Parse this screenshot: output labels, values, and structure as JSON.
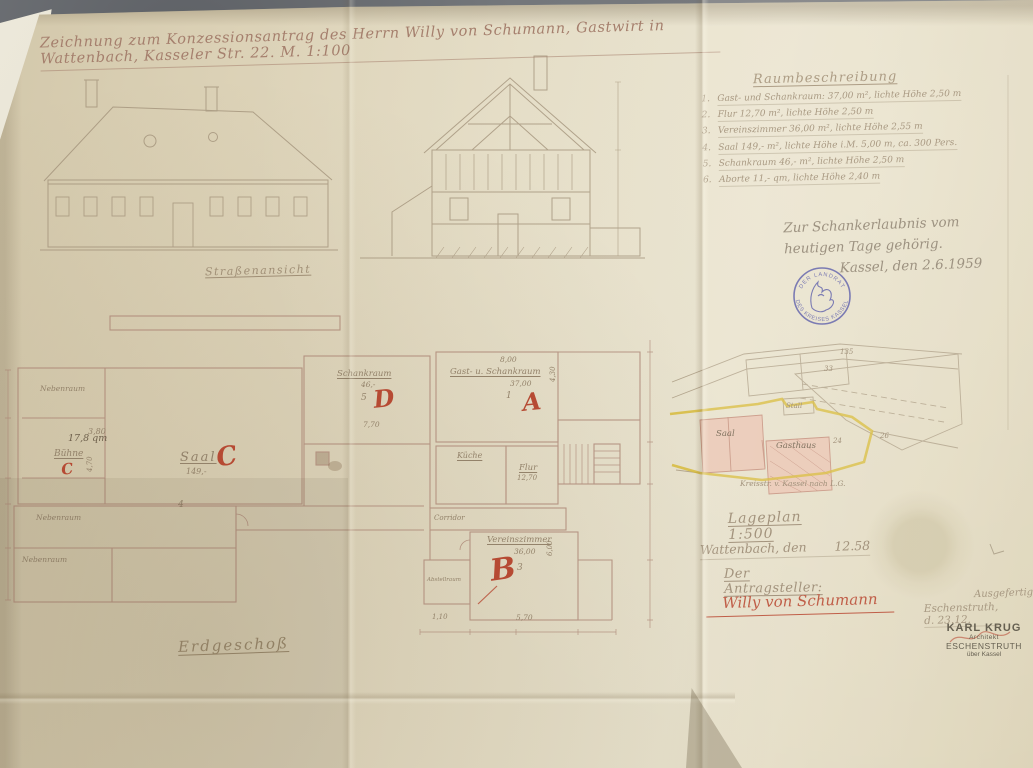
{
  "colors": {
    "paper": "#ded4ba",
    "background": "#74777b",
    "pencil": "#9b8a72",
    "red_ink": "#b64a33",
    "blue_stamp": "#4649a2",
    "yellow_boundary": "#d6b832",
    "pink_building": "#eac3b2"
  },
  "title": {
    "text": "Zeichnung zum Konzessionsantrag des Herrn Willy von Schumann, Gastwirt in Wattenbach, Kasseler Str. 22. M. 1:100"
  },
  "room_description": {
    "heading": "Raumbeschreibung",
    "items": [
      {
        "num": "1.",
        "text": "Gast- und Schankraum: 37,00 m², lichte Höhe 2,50 m"
      },
      {
        "num": "2.",
        "text": "Flur 12,70 m², lichte Höhe 2,50 m"
      },
      {
        "num": "3.",
        "text": "Vereinszimmer 36,00 m², lichte Höhe 2,55 m"
      },
      {
        "num": "4.",
        "text": "Saal 149,- m², lichte Höhe i.M. 5,00 m, ca. 300 Pers."
      },
      {
        "num": "5.",
        "text": "Schankraum 46,- m², lichte Höhe 2,50 m"
      },
      {
        "num": "6.",
        "text": "Aborte 11,- qm, lichte Höhe 2,40 m"
      }
    ]
  },
  "approval_note": {
    "line1": "Zur Schankerlaubnis vom",
    "line2": "heutigen Tage gehörig.",
    "line3": "Kassel, den 2.6.1959"
  },
  "official_stamp": {
    "top": "DER LANDRAT",
    "bottom": "DES KREISES KASSEL"
  },
  "elevation": {
    "caption": "Straßenansicht"
  },
  "floor_plan": {
    "caption": "Erdgeschoß",
    "labels": [
      {
        "text": "Nebenraum",
        "x": 40,
        "y": 384,
        "fs": 7.5
      },
      {
        "text": "3,80",
        "x": 88,
        "y": 427,
        "fs": 8
      },
      {
        "text": "17,8 qm",
        "x": 68,
        "y": 433,
        "fs": 9.5,
        "cls": "dark"
      },
      {
        "text": "Bühne",
        "x": 54,
        "y": 449,
        "fs": 9,
        "u": true
      },
      {
        "text": "C",
        "x": 60,
        "y": 461,
        "fs": 15,
        "cls": "red",
        "rot": -8
      },
      {
        "text": "4,70",
        "x": 86,
        "y": 472,
        "fs": 7,
        "rot": -90
      },
      {
        "text": "Saal",
        "x": 180,
        "y": 450,
        "fs": 13,
        "ls": 2,
        "u": true
      },
      {
        "text": "149,-",
        "x": 186,
        "y": 467,
        "fs": 8
      },
      {
        "text": "C",
        "x": 214,
        "y": 444,
        "fs": 26,
        "cls": "red",
        "rot": -10
      },
      {
        "text": "4",
        "x": 178,
        "y": 500,
        "fs": 9
      },
      {
        "text": "Nebenraum",
        "x": 36,
        "y": 513,
        "fs": 7.5
      },
      {
        "text": "Nebenraum",
        "x": 22,
        "y": 555,
        "fs": 7.5
      },
      {
        "text": "Schankraum",
        "x": 337,
        "y": 369,
        "fs": 8.5,
        "u": true
      },
      {
        "text": "46,-",
        "x": 361,
        "y": 380,
        "fs": 7.5
      },
      {
        "text": "5",
        "x": 361,
        "y": 393,
        "fs": 9
      },
      {
        "text": "D",
        "x": 372,
        "y": 385,
        "fs": 24,
        "cls": "red",
        "rot": -6
      },
      {
        "text": "7,70",
        "x": 363,
        "y": 420,
        "fs": 7.5
      },
      {
        "text": "8,00",
        "x": 500,
        "y": 355,
        "fs": 7.5
      },
      {
        "text": "Gast- u. Schankraum",
        "x": 450,
        "y": 367,
        "fs": 8.5,
        "u": true
      },
      {
        "text": "37,00",
        "x": 510,
        "y": 379,
        "fs": 7.5
      },
      {
        "text": "1",
        "x": 506,
        "y": 391,
        "fs": 9
      },
      {
        "text": "A",
        "x": 521,
        "y": 388,
        "fs": 24,
        "cls": "red",
        "rot": -6
      },
      {
        "text": "4,30",
        "x": 549,
        "y": 382,
        "fs": 7,
        "rot": -90
      },
      {
        "text": "Küche",
        "x": 457,
        "y": 451,
        "fs": 8,
        "u": true
      },
      {
        "text": "Flur",
        "x": 519,
        "y": 463,
        "fs": 8.5,
        "u": true
      },
      {
        "text": "12,70",
        "x": 517,
        "y": 474,
        "fs": 7
      },
      {
        "text": "Corridor",
        "x": 434,
        "y": 514,
        "fs": 7
      },
      {
        "text": "Vereinszimmer",
        "x": 487,
        "y": 535,
        "fs": 8.5,
        "u": true
      },
      {
        "text": "36,00",
        "x": 514,
        "y": 547,
        "fs": 7.5
      },
      {
        "text": "B",
        "x": 488,
        "y": 554,
        "fs": 30,
        "cls": "red",
        "rot": -8
      },
      {
        "text": "3",
        "x": 517,
        "y": 563,
        "fs": 9
      },
      {
        "text": "6,00",
        "x": 546,
        "y": 556,
        "fs": 7,
        "rot": -90
      },
      {
        "text": "Abstellraum",
        "x": 427,
        "y": 577,
        "fs": 5.5
      },
      {
        "text": "5,70",
        "x": 516,
        "y": 613,
        "fs": 7.5
      },
      {
        "text": "1,10",
        "x": 432,
        "y": 613,
        "fs": 7
      }
    ]
  },
  "site_plan": {
    "labels": [
      {
        "text": "Stall",
        "x": 786,
        "y": 402,
        "fs": 7
      },
      {
        "text": "Saal",
        "x": 716,
        "y": 429,
        "fs": 8.5,
        "cls": "dark"
      },
      {
        "text": "Gasthaus",
        "x": 776,
        "y": 441,
        "fs": 8.5,
        "cls": "dark"
      },
      {
        "text": "135",
        "x": 840,
        "y": 348,
        "fs": 7
      },
      {
        "text": "33",
        "x": 824,
        "y": 365,
        "fs": 7
      },
      {
        "text": "24",
        "x": 833,
        "y": 437,
        "fs": 7
      },
      {
        "text": "26",
        "x": 880,
        "y": 432,
        "fs": 7
      },
      {
        "text": "Kreisstr. v. Kassel nach L.G.",
        "x": 740,
        "y": 479,
        "fs": 7.5
      }
    ]
  },
  "signature_block": {
    "plan_scale": "Lageplan 1:500",
    "place_date": "Wattenbach, den       12.58",
    "applicant_label": "Der Antragsteller:",
    "signature": "Willy von Schumann",
    "exec_note": "Ausgefertigt",
    "exec_place_date": "Eschenstruth, d. 23.12.",
    "architect_stamp": {
      "line1": "KARL KRUG",
      "line2": "Architekt",
      "line3": "ESCHENSTRUTH",
      "line4": "über Kassel"
    }
  }
}
